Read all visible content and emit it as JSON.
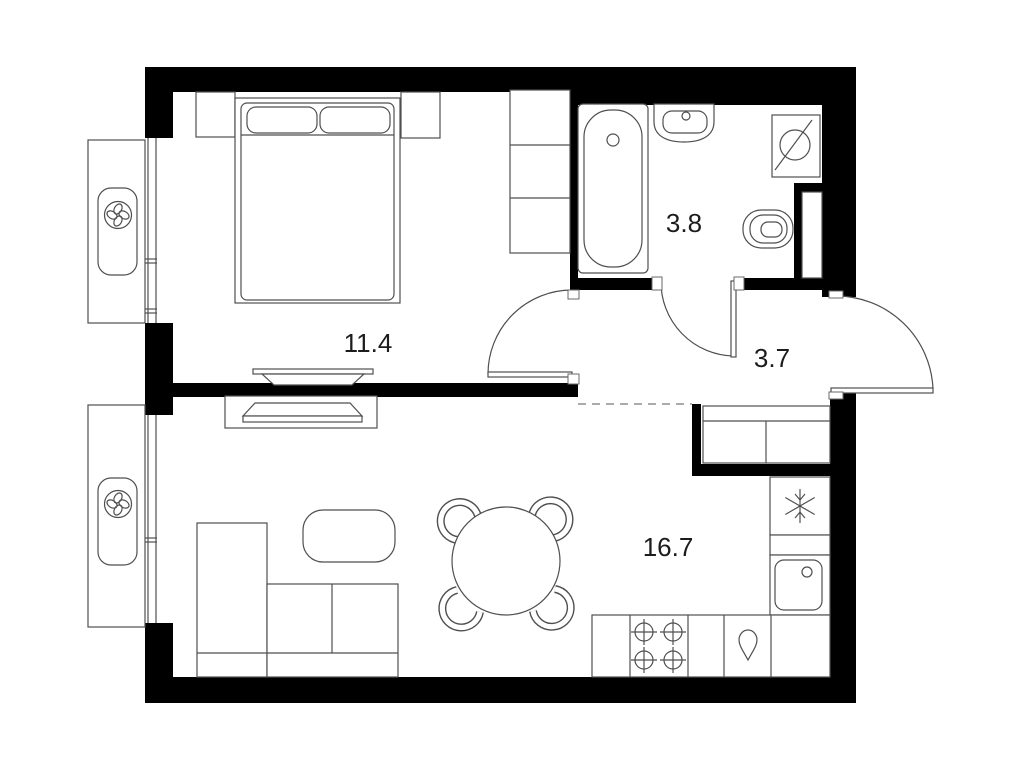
{
  "plan": {
    "kind": "apartment-floor-plan",
    "background": "#ffffff",
    "wall_color": "#000000",
    "line_color": "#4f4f4f",
    "label_color": "#1c1c1c"
  },
  "rooms": [
    {
      "id": "bedroom",
      "area_label": "11.4"
    },
    {
      "id": "bathroom",
      "area_label": "3.8"
    },
    {
      "id": "hallway",
      "area_label": "3.7"
    },
    {
      "id": "living-kitchen",
      "area_label": "16.7"
    }
  ],
  "fixtures": {
    "bedroom": [
      "double-bed",
      "pillow-left",
      "pillow-right",
      "nightstand-left",
      "nightstand-right",
      "wardrobe-shelves",
      "tv-unit"
    ],
    "bathroom": [
      "bathtub",
      "washbasin",
      "washing-machine",
      "toilet",
      "vent-duct"
    ],
    "hallway": [
      "entry-door",
      "built-in-closet"
    ],
    "living_kitchen": [
      "corner-sofa",
      "coffee-table",
      "tv-console",
      "dining-table",
      "dining-chairs",
      "fridge",
      "kitchen-sink",
      "stove",
      "counter-run",
      "water-drop-unit"
    ],
    "facade": [
      "window-bedroom",
      "window-living",
      "ac-basket-bedroom",
      "ac-basket-living"
    ]
  },
  "icons": [
    {
      "name": "fan-icon",
      "shape": "four-blade fan in circle"
    },
    {
      "name": "snowflake-icon",
      "shape": "six-arm snowflake"
    },
    {
      "name": "washing-machine-icon",
      "shape": "circle with diagonal slash"
    },
    {
      "name": "burner-icon",
      "shape": "circle with cross"
    },
    {
      "name": "water-drop-icon",
      "shape": "droplet, point down"
    },
    {
      "name": "tap-icon",
      "shape": "small circle"
    }
  ]
}
